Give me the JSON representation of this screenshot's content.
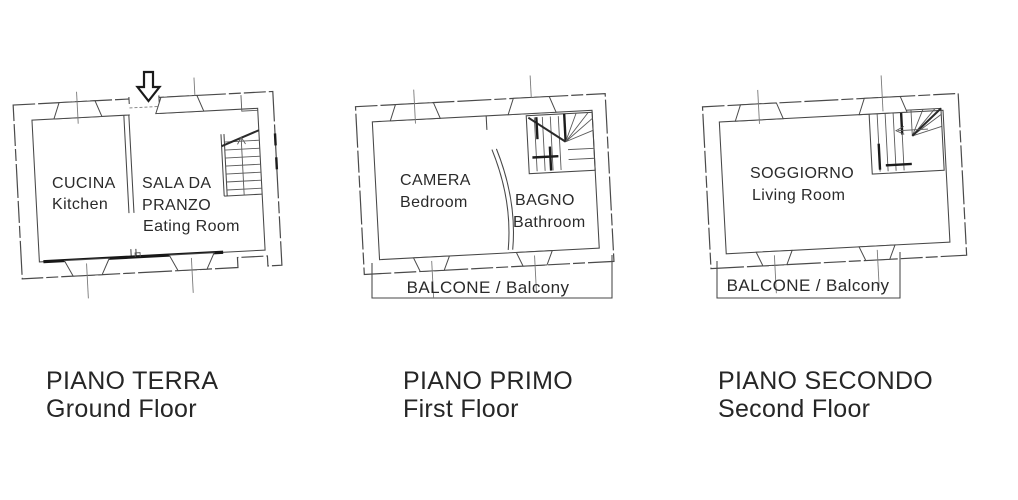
{
  "sheet": {
    "background": "#ffffff",
    "line_color": "#474747",
    "dark_wall_color": "#171717",
    "text_color": "#262626"
  },
  "floors": [
    {
      "title": "PIANO TERRA",
      "subtitle": "Ground Floor",
      "rooms": {
        "kitchen": {
          "it": "CUCINA",
          "en": "Kitchen"
        },
        "dining": {
          "it_line1": "SALA DA",
          "it_line2": "PRANZO",
          "en": "Eating Room"
        }
      },
      "features": [
        "entrance-arrow",
        "staircase",
        "windows"
      ]
    },
    {
      "title": "PIANO PRIMO",
      "subtitle": "First Floor",
      "rooms": {
        "bedroom": {
          "it": "CAMERA",
          "en": "Bedroom"
        },
        "bathroom": {
          "it": "BAGNO",
          "en": "Bathroom"
        }
      },
      "balcony_label": "BALCONE / Balcony",
      "features": [
        "staircase",
        "balcony",
        "windows"
      ]
    },
    {
      "title": "PIANO SECONDO",
      "subtitle": "Second Floor",
      "rooms": {
        "living": {
          "it": "SOGGIORNO",
          "en": "Living Room"
        }
      },
      "balcony_label": "BALCONE / Balcony",
      "features": [
        "staircase",
        "balcony",
        "windows"
      ]
    }
  ]
}
